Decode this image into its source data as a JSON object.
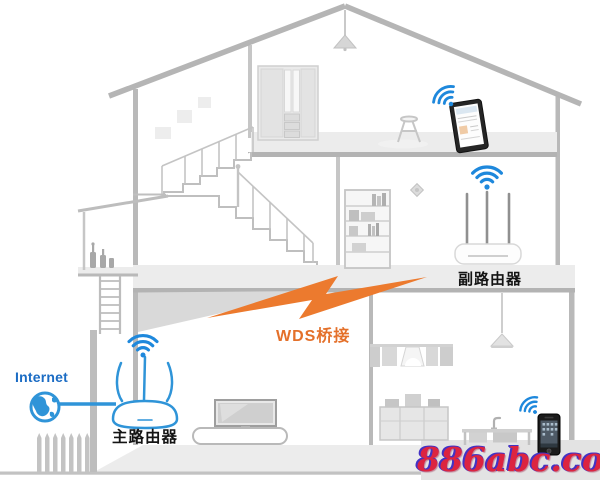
{
  "diagram": {
    "type": "wds-bridge-network-illustration",
    "internet_label": "Internet",
    "main_router_label": "主路由器",
    "secondary_router_label": "副路由器",
    "bridge_label": "WDS桥接",
    "watermark": "886abc.com"
  },
  "icons": {
    "wifi": "wifi-signal-arcs",
    "globe": "internet-globe",
    "bolt": "lightning-bolt",
    "devices": [
      "tablet",
      "smartphone",
      "tv",
      "main-router",
      "secondary-router"
    ]
  },
  "colors": {
    "wifi_blue": "#1e88dc",
    "router_outline_blue": "#2f94d8",
    "internet_text_blue": "#1b6cc4",
    "bridge_orange": "#ec7a2e",
    "label_black": "#141414",
    "structure_gray": "#b5b5b5",
    "watermark_red": "#dc2440",
    "watermark_blue": "#4332c4"
  }
}
